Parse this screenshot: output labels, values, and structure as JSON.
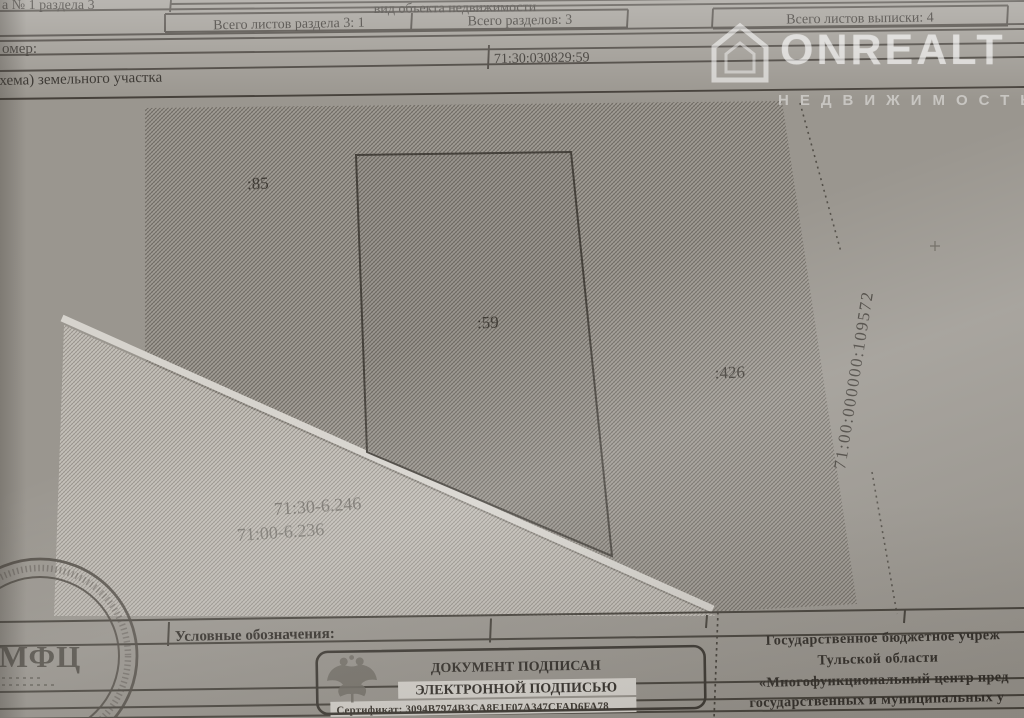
{
  "document": {
    "header": {
      "row1_left": "а № 1 раздела 3",
      "object_kind": "вид объекта недвижимости",
      "totals": {
        "sheets_section": "Всего листов раздела 3: 1",
        "sections": "Всего разделов: 3",
        "sheets_extract": "Всего листов выписки: 4"
      },
      "number_label": "омер:",
      "cadastral_number": "71:30:030829:59",
      "plan_title": "(схема) земельного участка"
    },
    "plan": {
      "parcel_labels": [
        ":85",
        ":59",
        ":426"
      ],
      "zone_labels": [
        "71:30-6.246",
        "71:00-6.236"
      ],
      "boundary_label": "71:00:000000:109572"
    },
    "legend_label": "Условные обозначения:",
    "signature_block": {
      "line1": "ДОКУМЕНТ ПОДПИСАН",
      "line2": "ЭЛЕКТРОННОЙ ПОДПИСЬЮ",
      "certificate": "Сертификат: 3094B7974B3CA8E1F07A347CFAD6FA78"
    },
    "issuer": {
      "line1": "Государственное бюджетное учреж",
      "line2": "Тульской области",
      "line3": "«Многофункциональный центр пред",
      "line4": "государственных и муниципальных у"
    },
    "stamp_mfc": "МФЦ"
  },
  "watermark": {
    "brand": "ONREALT",
    "tagline": "НЕДВИЖИМОСТЬ"
  },
  "colors": {
    "paper": "#e6e3de",
    "ink": "#3e3a34",
    "hatch_dark": "#8f8b85",
    "hatch_light": "#b3afa8",
    "watermark": "rgba(255,255,255,0.55)"
  }
}
